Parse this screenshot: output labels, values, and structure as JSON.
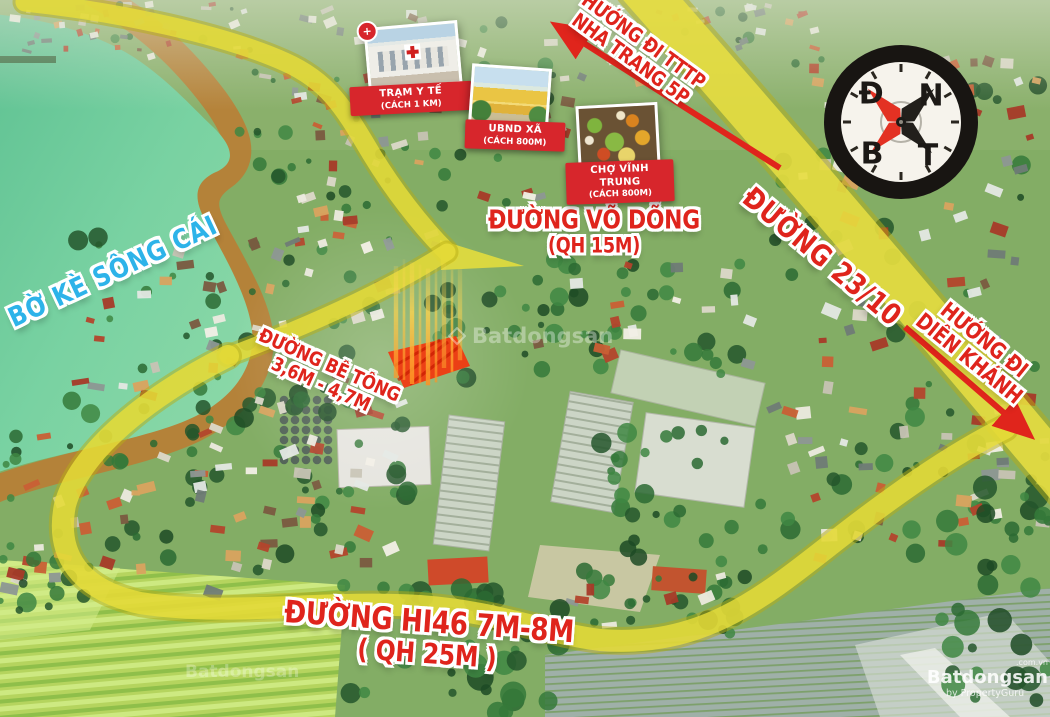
{
  "map_labels": {
    "river_embankment": "BỜ KÈ SÔNG CÁI",
    "road_23_10": "ĐƯỜNG 23/10",
    "road_vo_dong": {
      "line1": "ĐƯỜNG VÕ DÕNG",
      "line2": "(QH 15M)"
    },
    "road_be_tong": {
      "line1": "ĐƯỜNG BÊ TÔNG",
      "line2": "3,6M - 4,7M"
    },
    "road_hi46": {
      "line1": "ĐƯỜNG HI46 7M-8M",
      "line2": "( QH 25M )"
    },
    "direction_nha_trang": {
      "line1": "HƯỚNG ĐI TTTP",
      "line2": "NHA TRANG 5P"
    },
    "direction_dien_khanh": {
      "line1": "HƯỚNG ĐI",
      "line2": "DIÊN KHÁNH"
    }
  },
  "pois": [
    {
      "name": "TRẠM Y TẾ",
      "distance": "(CÁCH 1 KM)",
      "photo": "medical-station",
      "badge": "+"
    },
    {
      "name": "UBND XÃ",
      "distance": "(CÁCH 800M)",
      "photo": "commune-office"
    },
    {
      "name": "CHỢ VĨNH TRUNG",
      "distance": "(CÁCH 800M)",
      "photo": "market"
    }
  ],
  "compass": {
    "top_left": "Đ",
    "top_right": "N",
    "bottom_left": "B",
    "bottom_right": "T"
  },
  "watermark": {
    "domain": ".com.vn",
    "brand": "Batdongsan",
    "byline": "by PropertyGuru",
    "center_brand": "Batdongsan"
  },
  "colors": {
    "road_highlight": "#e9df3b",
    "label_red": "#df241c",
    "river_label_blue": "#2db3e9",
    "banner_red": "#d7262c",
    "water_green": "#6fcf9e",
    "embankment_brown": "#bb7c33",
    "plot_highlight": "#ff2600"
  }
}
